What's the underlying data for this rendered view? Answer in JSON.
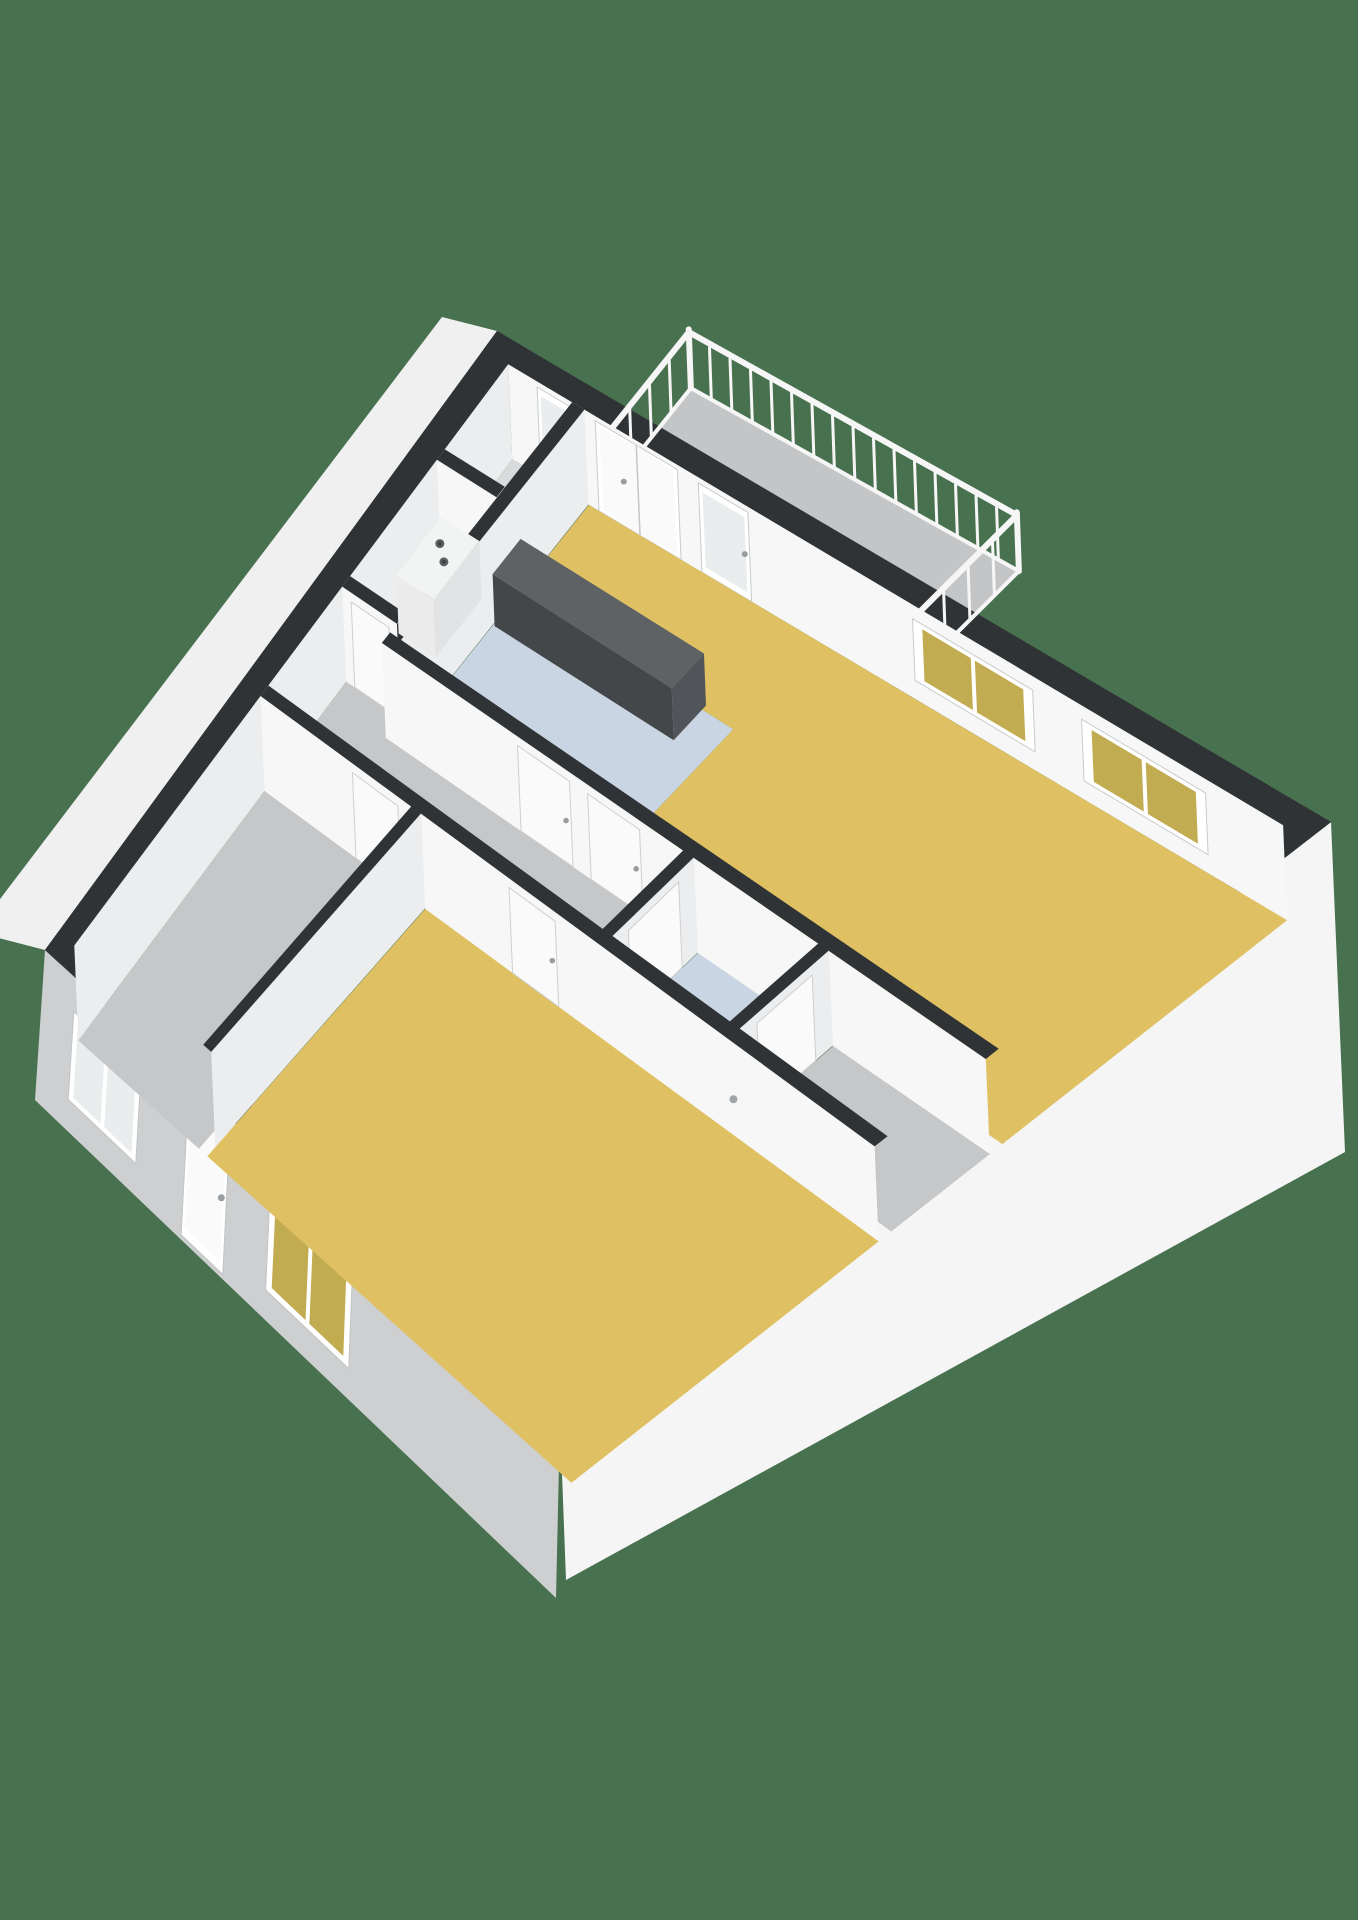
{
  "scene": {
    "type": "3d-floorplan-render",
    "background_color": "#48714F",
    "palette": {
      "wall_cap": "#303335",
      "wall_interior": "#F7F7F7",
      "wall_interior_shade": "#ECEDEE",
      "wall_exterior_bright": "#F5F5F5",
      "wall_exterior_gray": "#CDCFD0",
      "wall_exterior_nw": "#F0F0F0",
      "floor_yellow": "#DFC163",
      "floor_blue": "#C9D5E3",
      "floor_gray": "#C6C7C8",
      "floor_gray_light": "#D9DADB",
      "balcony_floor": "#C4C5C6",
      "glass_yellow": "#C2AC52",
      "glass_pale": "#E9EDED",
      "door_white": "#FAFAFA",
      "frame_white": "#FFFFFF",
      "counter_top": "#5E6265",
      "counter_front": "#44474A",
      "counter_side": "#515458",
      "boiler_body": "#F2F3F3",
      "boiler_front": "#EBEBEC",
      "boiler_side": "#E2E3E4",
      "railing_white": "#F6F6F6",
      "handle_gray": "#9A9DA0",
      "drain_gray": "#9FA4A8",
      "knob_gray": "#5E6163",
      "knob_dark": "#3F4244"
    },
    "rooms": [
      {
        "id": "living-room",
        "floor": "floor_yellow"
      },
      {
        "id": "kitchen",
        "floor": "floor_blue"
      },
      {
        "id": "closet",
        "floor": "floor_gray_light"
      },
      {
        "id": "boiler-closet",
        "floor": "floor_gray_light"
      },
      {
        "id": "hallway",
        "floor": "floor_gray"
      },
      {
        "id": "bathroom",
        "floor": "floor_blue"
      },
      {
        "id": "storage-room",
        "floor": "floor_gray"
      },
      {
        "id": "bedroom-left",
        "floor": "floor_gray"
      },
      {
        "id": "bedroom-main",
        "floor": "floor_yellow"
      },
      {
        "id": "balcony",
        "floor": "balcony_floor"
      }
    ],
    "features": {
      "balcony_railing": {
        "balusters_outer": 16,
        "balusters_side": 4
      },
      "boiler_knobs": 2,
      "ne_wall_openings": [
        "glass-door",
        "double-door",
        "glass-door",
        "window-2pane-yellow",
        "window-2pane-yellow"
      ],
      "sw_wall_openings": [
        "window-2pane",
        "entry-door",
        "window-2pane-yellow"
      ],
      "interior_doors": 7
    }
  }
}
